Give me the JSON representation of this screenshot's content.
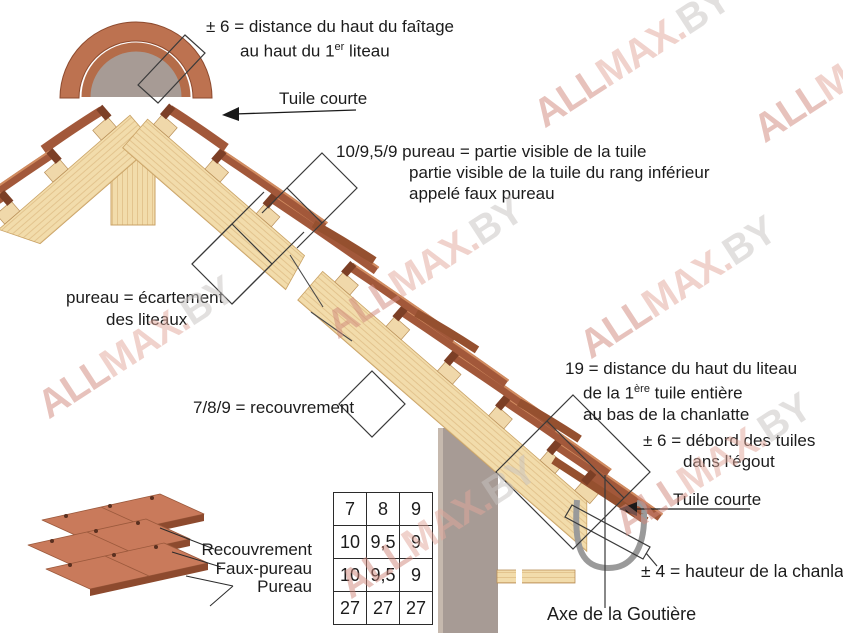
{
  "labels": {
    "faitage_l1": "± 6 = distance du haut du faîtage",
    "faitage_l2a": "au haut du 1",
    "faitage_l2_sup": "er",
    "faitage_l2b": " liteau",
    "tuile_courte_top": "Tuile courte",
    "pureau_visible_l1": "10/9,5/9 pureau = partie visible de la tuile",
    "pureau_visible_l2": "partie visible de la tuile du rang inférieur",
    "pureau_visible_l3": "appelé faux pureau",
    "ecartement_l1": "pureau = écartement",
    "ecartement_l2": "des liteaux",
    "recouvrement": "7/8/9 = recouvrement",
    "liteau_l1": "19 = distance du haut du liteau",
    "liteau_l2a": "de la 1",
    "liteau_l2_sup": "ère",
    "liteau_l2b": " tuile entière",
    "liteau_l3": "au bas de la chanlatte",
    "debord_l1": "± 6 = débord des tuiles",
    "debord_l2": "dans l’égout",
    "tuile_courte_bottom": "Tuile courte",
    "chanlatte": "± 4 = hauteur de la chanlatte",
    "axe_goutiere": "Axe de la Goutière"
  },
  "stack_labels": {
    "recouvrement": "Recouvrement",
    "faux_pureau": "Faux-pureau",
    "pureau": "Pureau"
  },
  "table": {
    "rows": [
      [
        "7",
        "8",
        "9"
      ],
      [
        "10",
        "9,5",
        "9"
      ],
      [
        "10",
        "9,5",
        "9"
      ],
      [
        "27",
        "27",
        "27"
      ]
    ]
  },
  "watermark": {
    "p1": "ALL",
    "p2": "MAX.",
    "p3": "BY"
  },
  "colors": {
    "tile": "#a2583a",
    "tile_highlight": "#d18c60",
    "tile_dark": "#7c3f26",
    "ridge_cap": "#bd7250",
    "wood": "#f2dcab",
    "wood_grain": "#e3c48e",
    "wall_gray": "#a79b95",
    "gutter_gray": "#9a9a9a",
    "line": "#3a3a3a",
    "text": "#1c1c1c"
  }
}
